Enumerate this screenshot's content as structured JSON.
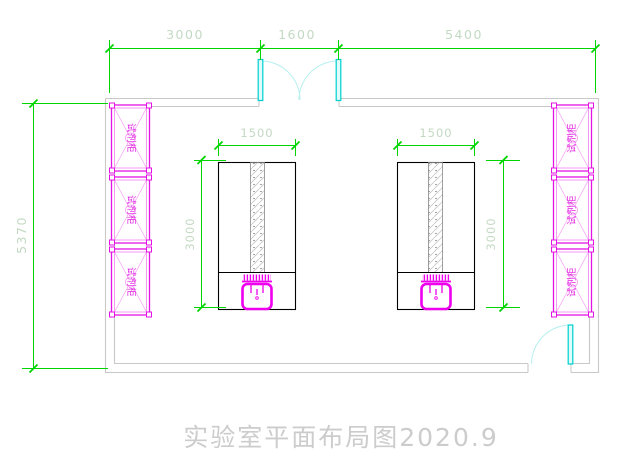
{
  "drawing_title": "实验室平面布局图2020.9",
  "colors": {
    "dimension_line": "#00d500",
    "dimension_text": "#c3d9c3",
    "wall": "#c9c9c9",
    "cabinet": "#e512e5",
    "cabinet_text": "#e020e0",
    "door_leaf": "#00cfcf",
    "door_swing": "#b7efef",
    "bench_outline": "#000000",
    "sink": "#ee00ee",
    "title_text": "#cccccc"
  },
  "dimensions": {
    "top": [
      {
        "label": "3000"
      },
      {
        "label": "1600"
      },
      {
        "label": "5400"
      }
    ],
    "left_wall": {
      "label": "5370"
    },
    "left_bench": {
      "width": "1500",
      "depth": "3000"
    },
    "right_bench": {
      "width": "1500",
      "depth": "3000"
    }
  },
  "cabinets": {
    "left": [
      {
        "label": "试剂柜"
      },
      {
        "label": "试剂柜"
      },
      {
        "label": "试剂柜"
      }
    ],
    "right": [
      {
        "label": "试剂柜"
      },
      {
        "label": "试剂柜"
      },
      {
        "label": "试剂柜"
      }
    ]
  }
}
